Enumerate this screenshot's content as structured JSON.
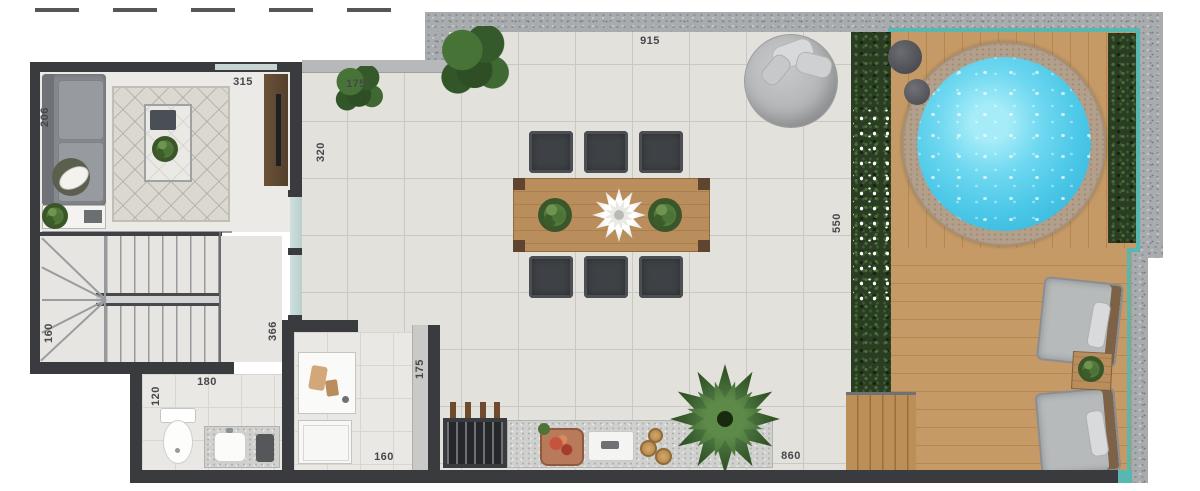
{
  "plan": {
    "type": "penthouse-rooftop-floor-plan",
    "labels": [
      {
        "name": "terrace-top-width",
        "text": "915"
      },
      {
        "name": "living-room-width",
        "text": "315"
      },
      {
        "name": "terrace-upper-left-width",
        "text": "175"
      },
      {
        "name": "living-room-left-depth",
        "text": "206"
      },
      {
        "name": "living-terrace-wall-height",
        "text": "320"
      },
      {
        "name": "stairs-width",
        "text": "160"
      },
      {
        "name": "bathroom-depth",
        "text": "120"
      },
      {
        "name": "bathroom-width",
        "text": "180"
      },
      {
        "name": "hall-wall-height",
        "text": "366"
      },
      {
        "name": "bbq-wall-height",
        "text": "175"
      },
      {
        "name": "support-room-width",
        "text": "160"
      },
      {
        "name": "pool-deck-depth",
        "text": "550"
      },
      {
        "name": "terrace-bottom-width",
        "text": "860"
      }
    ],
    "colors": {
      "wall_dark": "#3a3b3e",
      "granite_wall": "#a8acaf",
      "glass_rail_teal": "#58b7b1",
      "pool_water": "#4cc8e8",
      "pool_rim": "#b3a08c",
      "deck_wood": "#c0955f",
      "hedge_green": "#2a3d22",
      "terrace_tile": "#e3e1dc",
      "furniture_wood": "#b98d5c",
      "chair_dark": "#3e4145"
    }
  }
}
